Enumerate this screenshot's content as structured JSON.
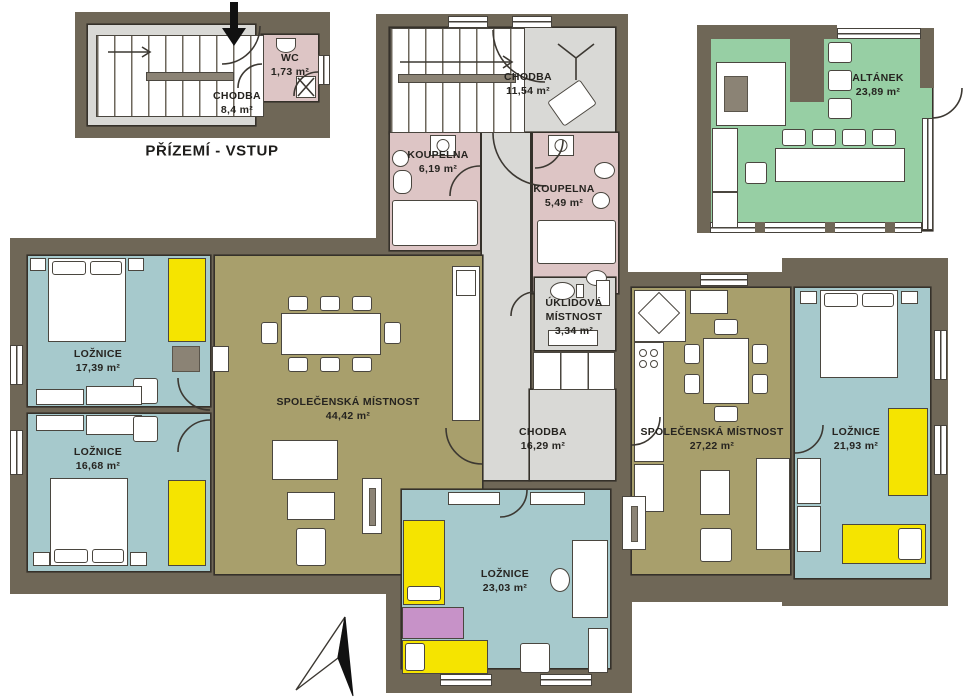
{
  "caption": "PŘÍZEMÍ - VSTUP",
  "rooms": {
    "entry_hall": {
      "name": "CHODBA",
      "area": "8,4 m²"
    },
    "wc": {
      "name": "WC",
      "area": "1,73 m²"
    },
    "upper_hall": {
      "name": "CHODBA",
      "area": "11,54 m²"
    },
    "bath_left": {
      "name": "KOUPELNA",
      "area": "6,19 m²"
    },
    "bath_right": {
      "name": "KOUPELNA",
      "area": "5,49 m²"
    },
    "utility": {
      "name": "ÚKLIDOVÁ MÍSTNOST",
      "area": "3,34 m²"
    },
    "gazebo": {
      "name": "ALTÁNEK",
      "area": "23,89 m²"
    },
    "bedroom_1": {
      "name": "LOŽNICE",
      "area": "17,39 m²"
    },
    "bedroom_2": {
      "name": "LOŽNICE",
      "area": "16,68 m²"
    },
    "living_main": {
      "name": "SPOLEČENSKÁ MÍSTNOST",
      "area": "44,42 m²"
    },
    "main_hall": {
      "name": "CHODBA",
      "area": "16,29 m²"
    },
    "living_right": {
      "name": "SPOLEČENSKÁ MÍSTNOST",
      "area": "27,22 m²"
    },
    "bedroom_3": {
      "name": "LOŽNICE",
      "area": "21,93 m²"
    },
    "bedroom_4": {
      "name": "LOŽNICE",
      "area": "23,03 m²"
    }
  },
  "icons": [
    "entrance-arrow",
    "north-arrow",
    "coat-stand",
    "stairs-direction-arrow",
    "door-arc",
    "shower-x"
  ],
  "colors": {
    "wall": "#6f6757",
    "hall_floor": "#d9d9d6",
    "bedroom_floor": "#a6c9cc",
    "living_floor": "#a89f6c",
    "bathroom_floor": "#ddc5c5",
    "gazebo_floor": "#97cfa4",
    "wardrobe_yellow": "#f5e400",
    "furniture_purple": "#c792c8",
    "furniture_white": "#ffffff"
  }
}
